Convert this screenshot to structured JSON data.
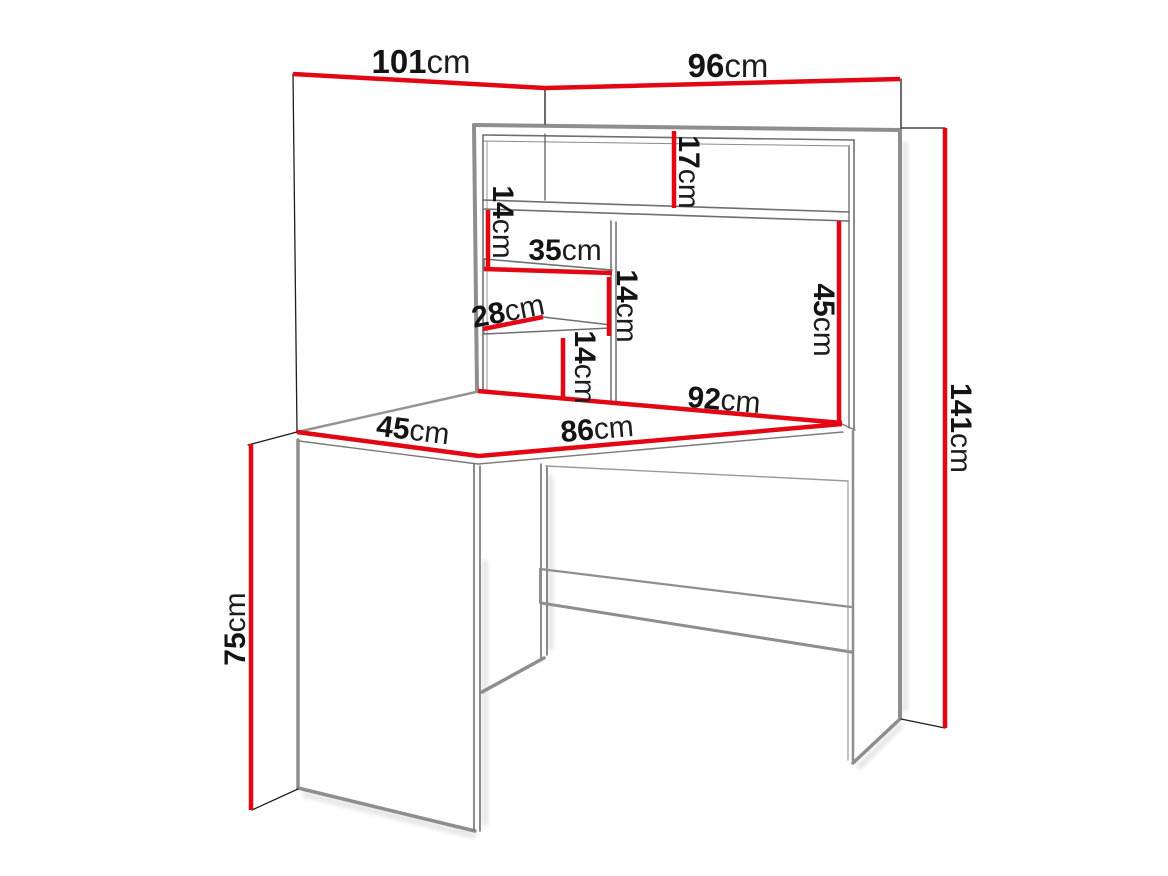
{
  "diagram": {
    "kind": "furniture dimension drawing",
    "subject": "corner desk with hutch shelving",
    "unit": "cm"
  },
  "colors": {
    "dimension_line": "#e30613",
    "outline_thick": "#8e8e8e",
    "outline_thin": "#6f6f6f",
    "wall_line": "#1e1e1e",
    "text": "#141414",
    "background": "#ffffff"
  },
  "dimensions": {
    "wall_left_width": {
      "value": "101",
      "unit": "cm"
    },
    "wall_right_width": {
      "value": "96",
      "unit": "cm"
    },
    "hutch_top_gap": {
      "value": "17",
      "unit": "cm"
    },
    "shelf_gap_top": {
      "value": "14",
      "unit": "cm"
    },
    "shelf_top_width": {
      "value": "35",
      "unit": "cm"
    },
    "shelf_gap_middle": {
      "value": "14",
      "unit": "cm"
    },
    "shelf_bottom_depth": {
      "value": "28",
      "unit": "cm"
    },
    "shelf_gap_bottom": {
      "value": "14",
      "unit": "cm"
    },
    "hutch_compartment_height": {
      "value": "45",
      "unit": "cm"
    },
    "desktop_back_width": {
      "value": "92",
      "unit": "cm"
    },
    "desktop_side_depth": {
      "value": "45",
      "unit": "cm"
    },
    "desktop_front_width": {
      "value": "86",
      "unit": "cm"
    },
    "desk_height": {
      "value": "75",
      "unit": "cm"
    },
    "total_height": {
      "value": "141",
      "unit": "cm"
    }
  }
}
